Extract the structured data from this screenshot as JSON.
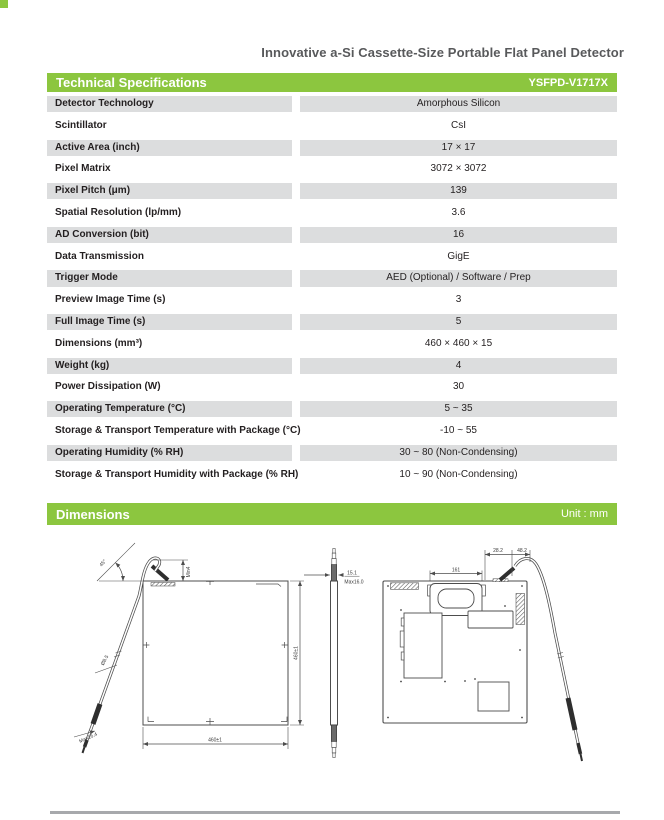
{
  "page": {
    "title": "Innovative a-Si Cassette-Size Portable Flat Panel Detector"
  },
  "spec_section": {
    "header": "Technical Specifications",
    "model": "YSFPD-V1717X",
    "rows": [
      {
        "label": "Detector Technology",
        "value": "Amorphous Silicon"
      },
      {
        "label": "Scintillator",
        "value": "CsI"
      },
      {
        "label": "Active Area (inch)",
        "value": "17 × 17"
      },
      {
        "label": "Pixel Matrix",
        "value": "3072 × 3072"
      },
      {
        "label": "Pixel Pitch (μm)",
        "value": "139"
      },
      {
        "label": "Spatial Resolution (lp/mm)",
        "value": "3.6"
      },
      {
        "label": "AD Conversion (bit)",
        "value": "16"
      },
      {
        "label": "Data Transmission",
        "value": "GigE"
      },
      {
        "label": "Trigger Mode",
        "value": "AED (Optional) / Software / Prep"
      },
      {
        "label": "Preview Image Time (s)",
        "value": "3"
      },
      {
        "label": "Full Image Time (s)",
        "value": "5"
      },
      {
        "label": "Dimensions (mm³)",
        "value": "460 × 460 × 15"
      },
      {
        "label": "Weight (kg)",
        "value": "4"
      },
      {
        "label": "Power Dissipation (W)",
        "value": "30"
      },
      {
        "label": "Operating Temperature (°C)",
        "value": "5 ~ 35"
      },
      {
        "label": "Storage & Transport Temperature with Package (°C)",
        "value": "-10 ~ 55"
      },
      {
        "label": "Operating Humidity (% RH)",
        "value": "30 ~ 80 (Non-Condensing)"
      },
      {
        "label": "Storage & Transport Humidity with Package (% RH)",
        "value": "10 ~ 90 (Non-Condensing)"
      }
    ]
  },
  "dimensions_section": {
    "header": "Dimensions",
    "unit": "Unit : mm",
    "labels": {
      "front_width": "460±1",
      "front_height": "460±1",
      "cable_angle": "45°",
      "cable_exit_min": "Min4",
      "cable_diameter": "Ø8.5",
      "connector_max": "Max16.4",
      "side_thickness": "15.1",
      "side_max": "Max16.0",
      "handle_width": "161",
      "cable_offset_1": "28.2",
      "cable_offset_2": "48.2"
    }
  },
  "colors": {
    "accent_green": "#8CC63F",
    "row_shade": "#DCDDDE",
    "title_gray": "#58595B",
    "text_dark": "#231F20",
    "drawing_stroke": "#4D4D4D",
    "bottom_rule_gray": "#A7A9AC"
  }
}
